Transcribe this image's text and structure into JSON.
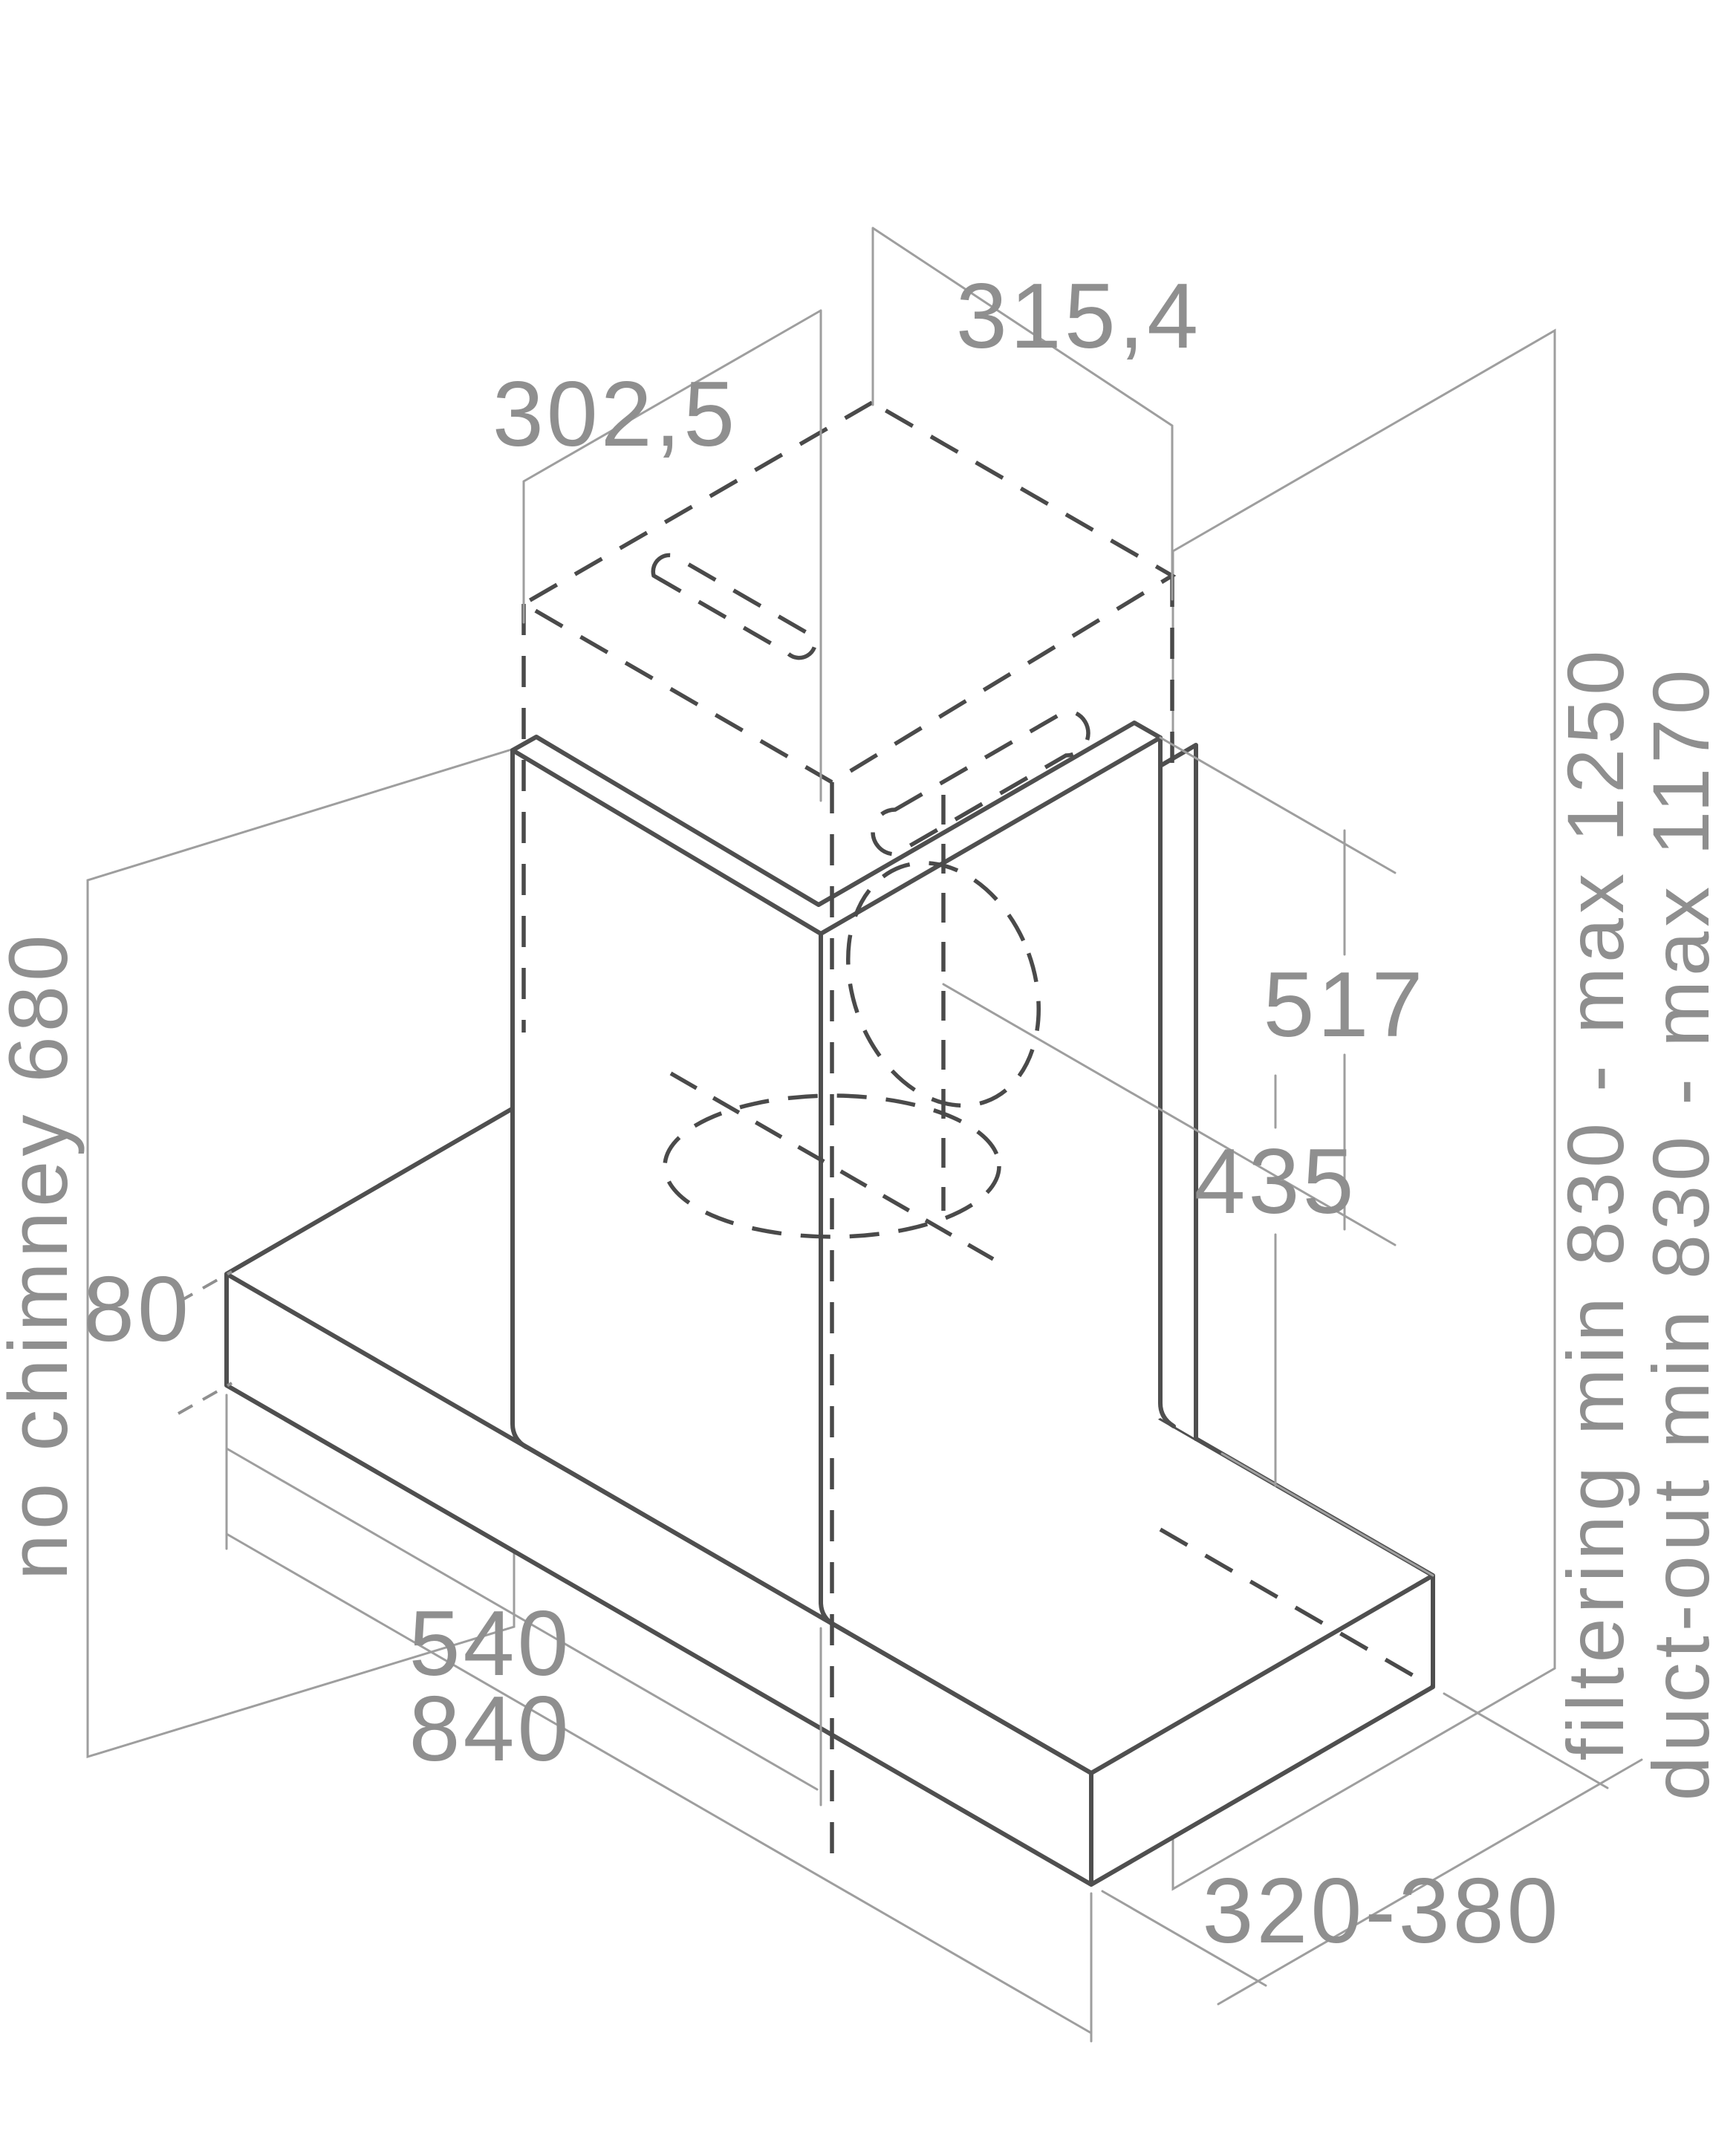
{
  "drawing": {
    "type": "isometric technical installation diagram of wall-mounted kitchen hood",
    "dimensions": {
      "chimney_width": "302,5",
      "chimney_depth": "315,4",
      "no_chimney_height": "no chimney 680",
      "base_height": "80",
      "duct_axis_from_top": "517",
      "duct_axis_from_base": "435",
      "inner_width": "540",
      "total_width": "840",
      "depth_range": "320-380",
      "filtering_range": "filtering min 830 - max 1250",
      "duct_out_range": "duct-out min 830 - max 1170"
    },
    "colors": {
      "line": "#4f4f4f",
      "dashed_line": "#4a4a4a",
      "thin_line": "#9e9e9e",
      "label": "#8f8f8f",
      "background": "#ffffff"
    }
  }
}
